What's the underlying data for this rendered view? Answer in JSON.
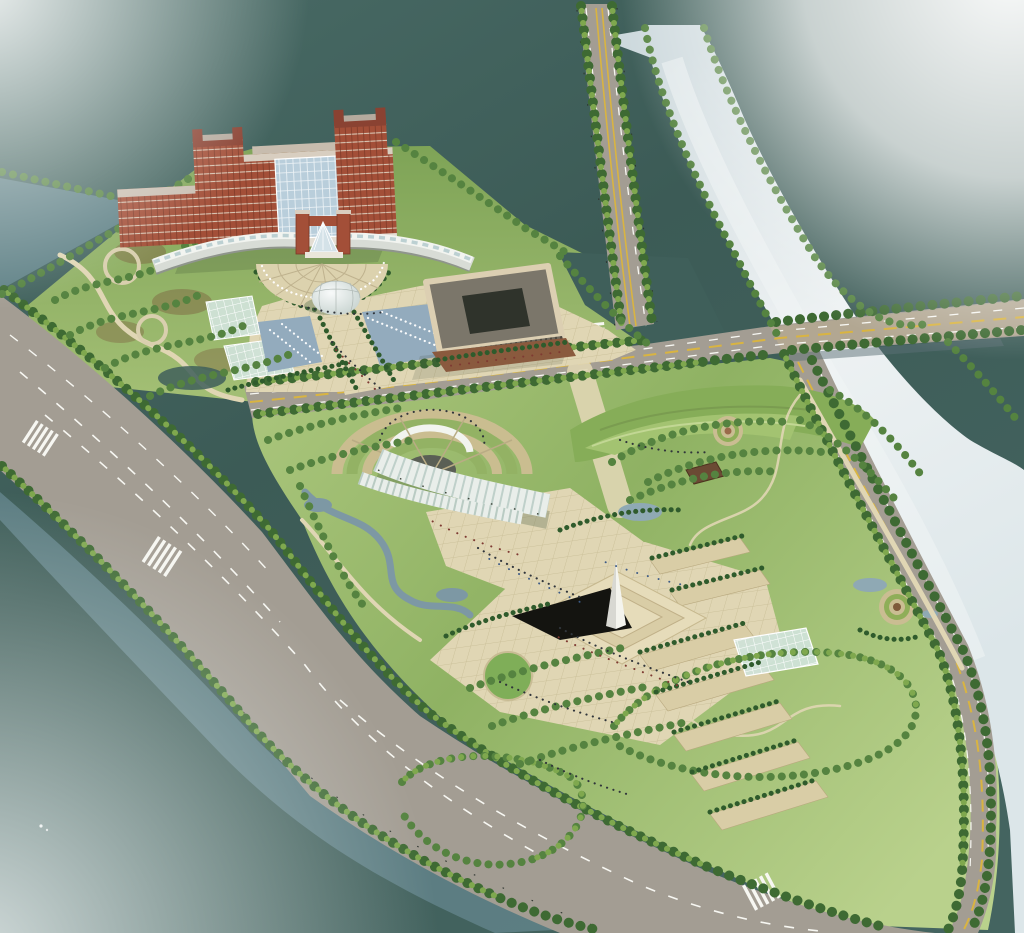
{
  "scene": {
    "type": "aerial-architectural-rendering",
    "description": "Bird's-eye master-plan rendering of a riverside civic campus: a red-brick high-rise complex with twin towers, curved white wing buildings, entrance gate and glass dome around a semicircular fountain plaza on the north parcel; a landscaped memorial park with white obelisk, stepped plaza, amphitheater with vaulted canopy, planter terraces, spiral parterres and formal tree-lined lawns on the south parcel; bounded by tree-lined boulevards, a canal, a crossing avenue and a silver river with a road bridge.",
    "elements": [
      {
        "name": "river",
        "label": "silver river"
      },
      {
        "name": "bridge",
        "label": "road bridge over river"
      },
      {
        "name": "canal",
        "label": "canal along boulevard"
      },
      {
        "name": "north-avenue",
        "label": "tree-lined avenue"
      },
      {
        "name": "crossroad",
        "label": "east-west road between parcels"
      },
      {
        "name": "boulevard",
        "label": "south-west boulevard"
      },
      {
        "name": "riverside-road",
        "label": "riverside road"
      },
      {
        "name": "main-tower-building",
        "label": "red-brick high-rise with twin towers"
      },
      {
        "name": "dormitory-block",
        "label": "brick dormitory block"
      },
      {
        "name": "entrance-gate",
        "label": "brick gate with glass atrium"
      },
      {
        "name": "curved-wing-buildings",
        "label": "curved white wings"
      },
      {
        "name": "semicircular-plaza",
        "label": "radial forecourt plaza"
      },
      {
        "name": "glass-dome",
        "label": "glass dome"
      },
      {
        "name": "fountain-pools",
        "label": "axis fountain pools"
      },
      {
        "name": "greenhouses",
        "label": "glass greenhouses"
      },
      {
        "name": "orchard-garden",
        "label": "orchard garden with winding paths"
      },
      {
        "name": "cube-office-building",
        "label": "courtyard office building"
      },
      {
        "name": "campus-pond",
        "label": "campus pond"
      },
      {
        "name": "amphitheater",
        "label": "terraced amphitheater"
      },
      {
        "name": "stage-canopy",
        "label": "striped vaulted stage canopy"
      },
      {
        "name": "obelisk-monument",
        "label": "white obelisk on stepped plinth"
      },
      {
        "name": "memorial-plaza",
        "label": "paved memorial plaza"
      },
      {
        "name": "circular-lawn",
        "label": "circular lawn"
      },
      {
        "name": "planter-terraces",
        "label": "stepped planter terraces"
      },
      {
        "name": "park-greenhouse",
        "label": "park greenhouse"
      },
      {
        "name": "garden-pavilion",
        "label": "garden pavilion"
      },
      {
        "name": "spiral-parterre",
        "label": "spiral parterre"
      },
      {
        "name": "circular-parterre",
        "label": "circular parterre"
      },
      {
        "name": "stream",
        "label": "winding stream and ponds"
      },
      {
        "name": "lawn-cells",
        "label": "tree-ringed lawns"
      },
      {
        "name": "street-trees",
        "label": "street tree rows"
      },
      {
        "name": "pedestrians",
        "label": "pedestrian groups"
      }
    ]
  },
  "palette": {
    "bg1": "#4a6c67",
    "bg2": "#3c5b56",
    "bg3": "#446460",
    "river1": "#cdd9dd",
    "river2": "#eef2f3",
    "river3": "#dce6e9",
    "canal": "#5f8186",
    "pond": "#3f5f5a",
    "stream": "#7d98a4",
    "road": "#a39d93",
    "roadLight": "#b3ada3",
    "bridge": "#bfae92",
    "laneWhite": "#f7f7f2",
    "laneYellow": "#d9b441",
    "treeDark": "#3e6a33",
    "treeMid": "#558340",
    "treeLight": "#7fa84e",
    "hedge": "#2f5b2c",
    "lawn1": "#a8c47a",
    "lawn2": "#8fb263",
    "lawn3": "#b9d18c",
    "campus1": "#7fa457",
    "campus2": "#a6c177",
    "paving": "#e0d6b4",
    "pavingLine": "#c5b890",
    "soil": "#7d5f3f",
    "brick": "#a34f38",
    "brickDark": "#8a4232",
    "band": "#d9cec0",
    "glass": "#b9cedb",
    "white": "#eceee9",
    "wingShade": "#8f958c",
    "obelisk": "#f4f4ee",
    "obeliskShade": "#d8d8d2",
    "shadowBlack": "#141410",
    "pool": "#93abbd",
    "canopy": "#e9eeea",
    "canopyRib": "#9db8ae",
    "roofBrown": "#6b4a34",
    "cube": "#6f6a5e",
    "cubeDark": "#3f3b33"
  }
}
